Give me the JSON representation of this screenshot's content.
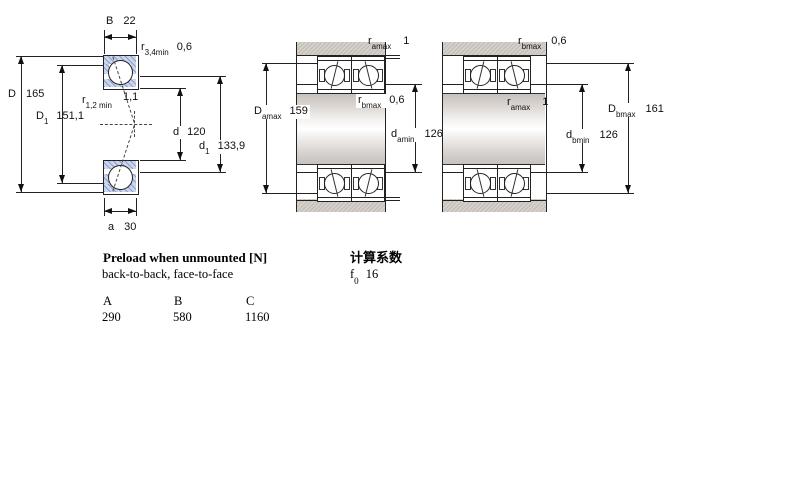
{
  "left_diagram": {
    "B": {
      "sym": "B",
      "value": "22"
    },
    "r34": {
      "sym": "r",
      "sub": "3,4min",
      "value": "0,6"
    },
    "D": {
      "sym": "D",
      "value": "165"
    },
    "D1": {
      "sym": "D",
      "sub": "1",
      "value": "151,1"
    },
    "r12": {
      "sym": "r",
      "sub": "1,2 min",
      "value": "1,1"
    },
    "d": {
      "sym": "d",
      "value": "120"
    },
    "d1": {
      "sym": "d",
      "sub": "1",
      "value": "133,9"
    },
    "a": {
      "sym": "a",
      "value": "30"
    }
  },
  "middle_diagram": {
    "ramax": {
      "sym": "r",
      "sub": "amax",
      "value": "1"
    },
    "Damax": {
      "sym": "D",
      "sub": "amax",
      "value": "159"
    },
    "rbmax": {
      "sym": "r",
      "sub": "bmax",
      "value": "0,6"
    },
    "damin": {
      "sym": "d",
      "sub": "amin",
      "value": "126"
    }
  },
  "right_diagram": {
    "rbmax": {
      "sym": "r",
      "sub": "bmax",
      "value": "0,6"
    },
    "ramax": {
      "sym": "r",
      "sub": "amax",
      "value": "1"
    },
    "Dbmax": {
      "sym": "D",
      "sub": "bmax",
      "value": "161"
    },
    "dbmin": {
      "sym": "d",
      "sub": "bmin",
      "value": "126"
    }
  },
  "preload_section": {
    "heading": "Preload when unmounted [N]",
    "subheading": "back-to-back, face-to-face",
    "columns": [
      "A",
      "B",
      "C"
    ],
    "values": [
      "290",
      "580",
      "1160"
    ]
  },
  "calc_section": {
    "heading": "计算系数",
    "factor": {
      "sym": "f",
      "sub": "0",
      "value": "16"
    }
  },
  "colors": {
    "ring_fill": "#cbd5ee",
    "housing_fill": "#d6d0ca",
    "line": "#222222",
    "background": "#ffffff"
  }
}
